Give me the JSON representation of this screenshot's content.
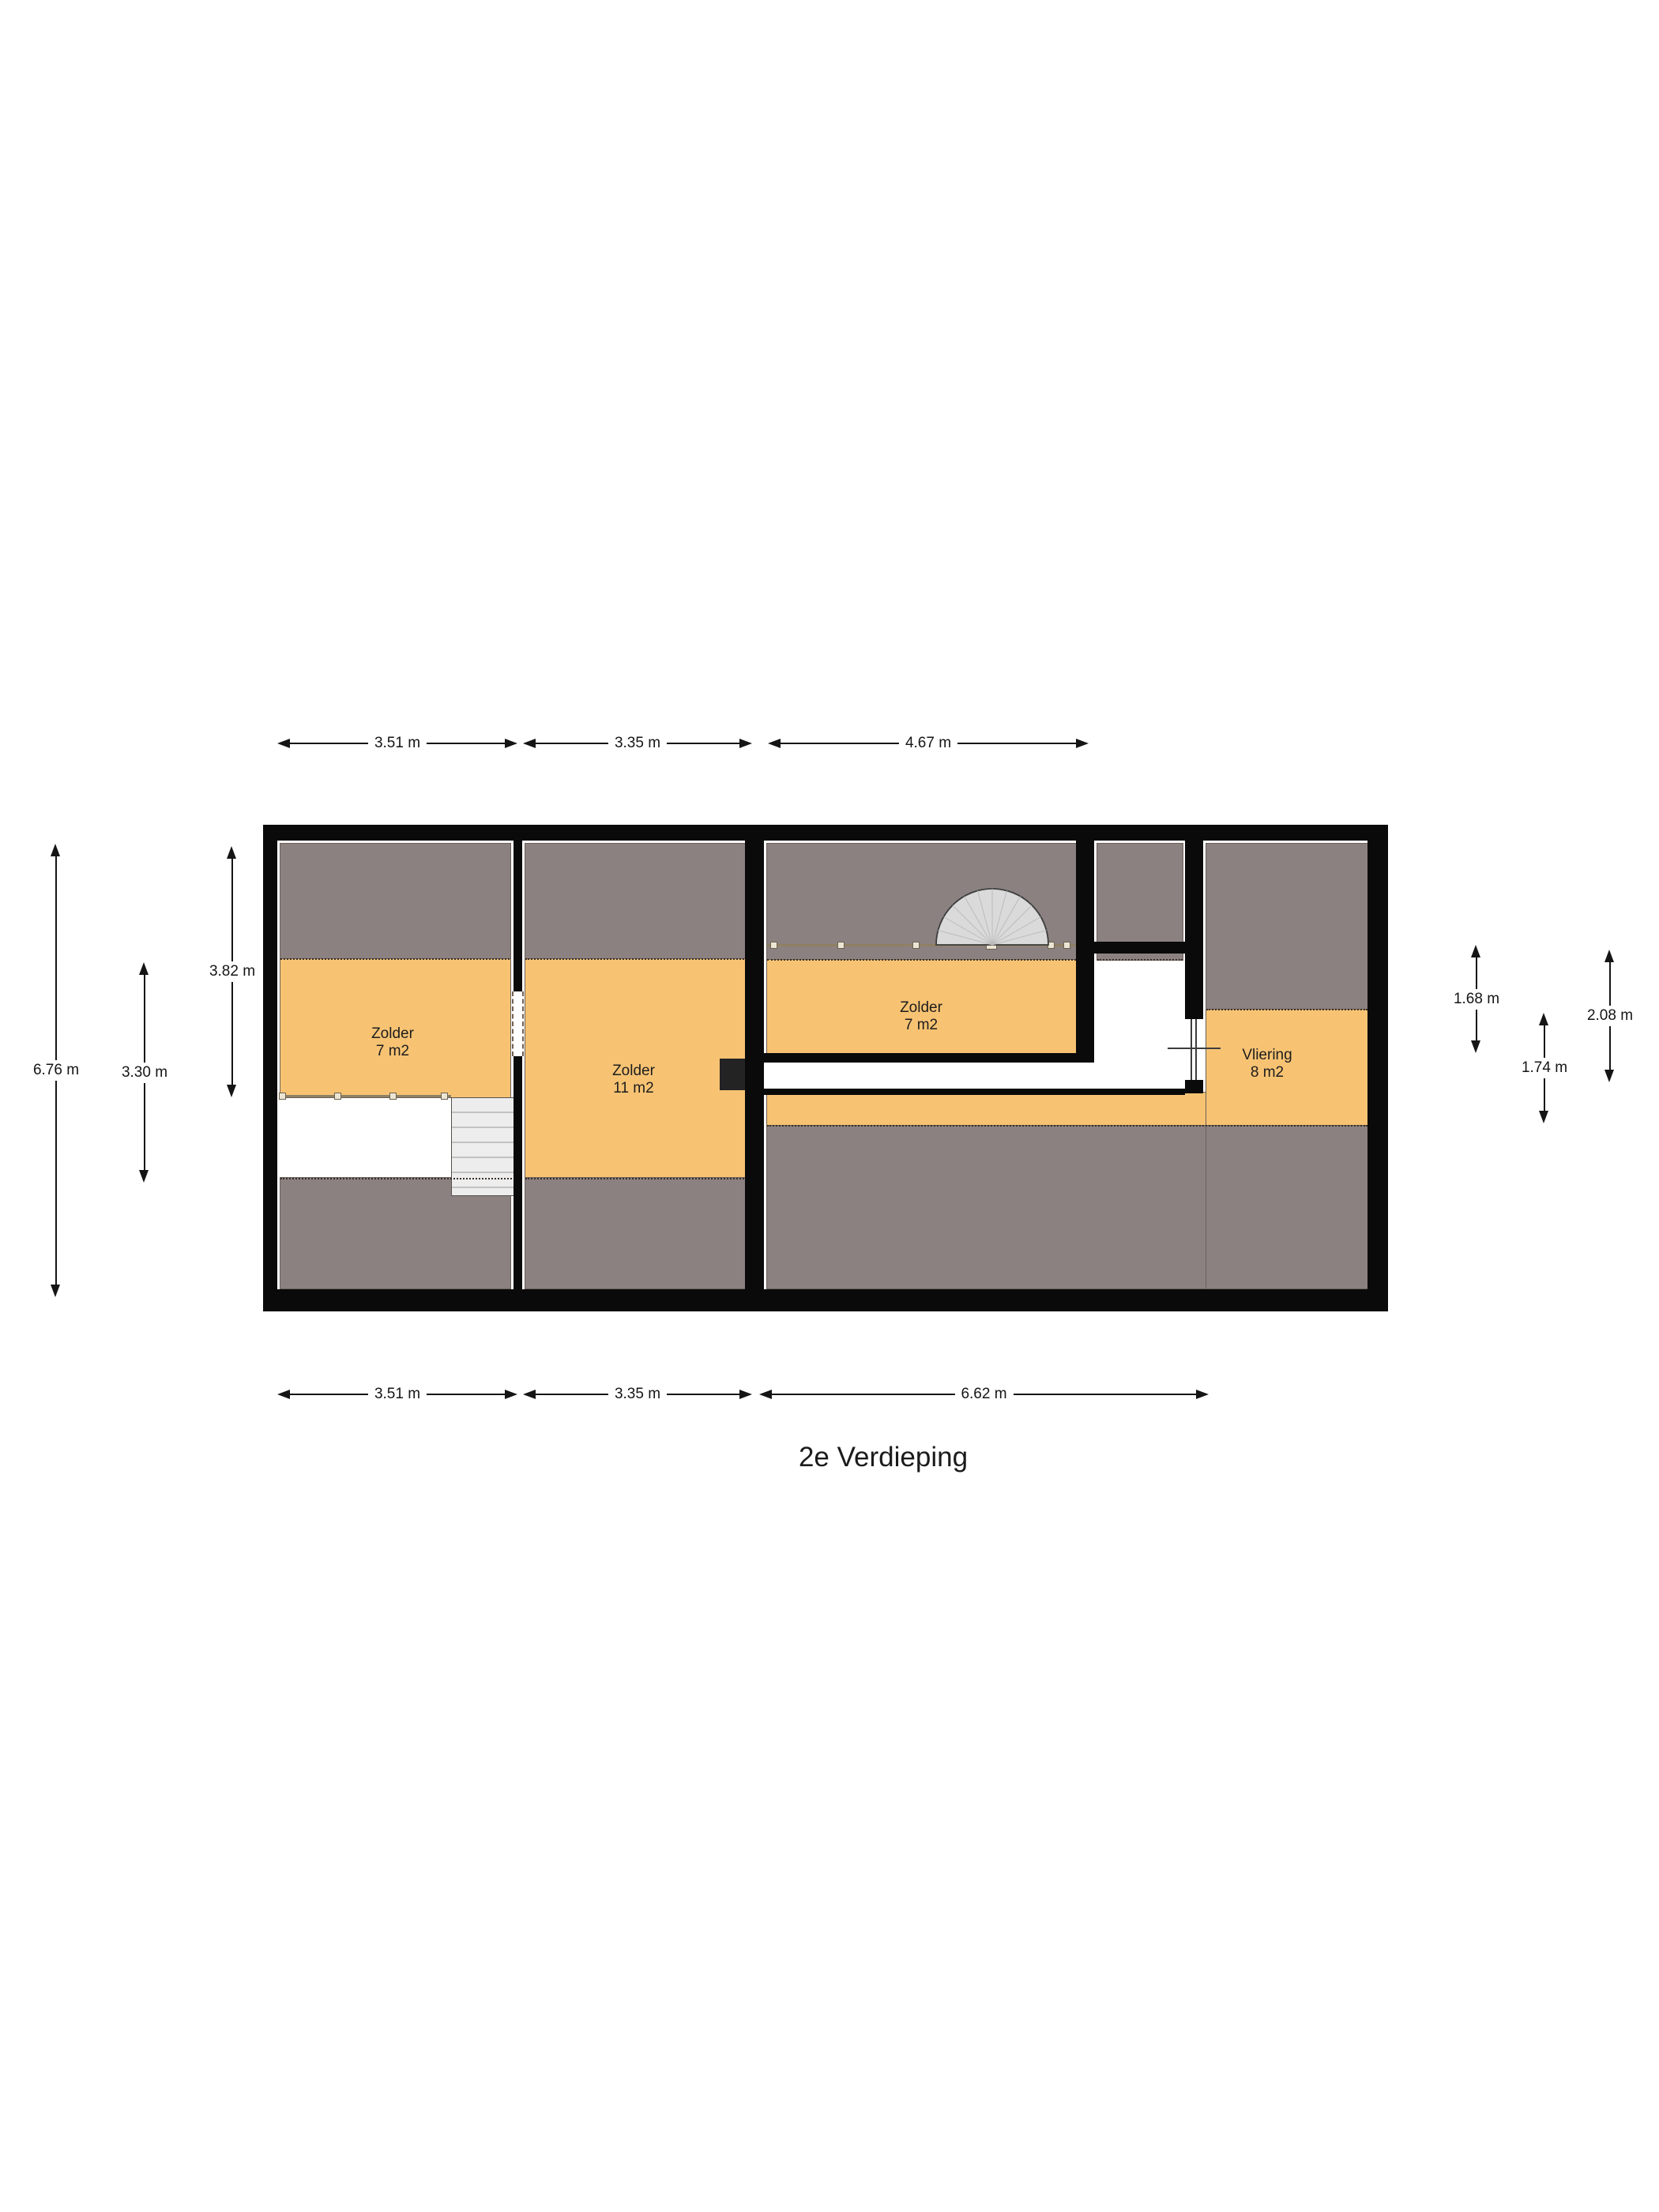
{
  "title": "2e Verdieping",
  "rooms": [
    {
      "name": "Zolder",
      "area": "7 m2"
    },
    {
      "name": "Zolder",
      "area": "11 m2"
    },
    {
      "name": "Zolder",
      "area": "7 m2"
    },
    {
      "name": "Vliering",
      "area": "8 m2"
    }
  ],
  "dimensions": {
    "top": [
      "3.51 m",
      "3.35 m",
      "4.67 m"
    ],
    "bottom": [
      "3.51 m",
      "3.35 m",
      "6.62 m"
    ],
    "left": [
      "6.76 m",
      "3.30 m",
      "3.82 m"
    ],
    "right": [
      "1.68 m",
      "2.08 m",
      "1.74 m"
    ]
  },
  "colors": {
    "floor": "#F7C373",
    "slope": "#8C8181",
    "wall": "#0A0A0A",
    "stairs": "#EDEDED",
    "railing": "#8E8063",
    "dotted": "#3A2F28",
    "dim": "#151515"
  }
}
